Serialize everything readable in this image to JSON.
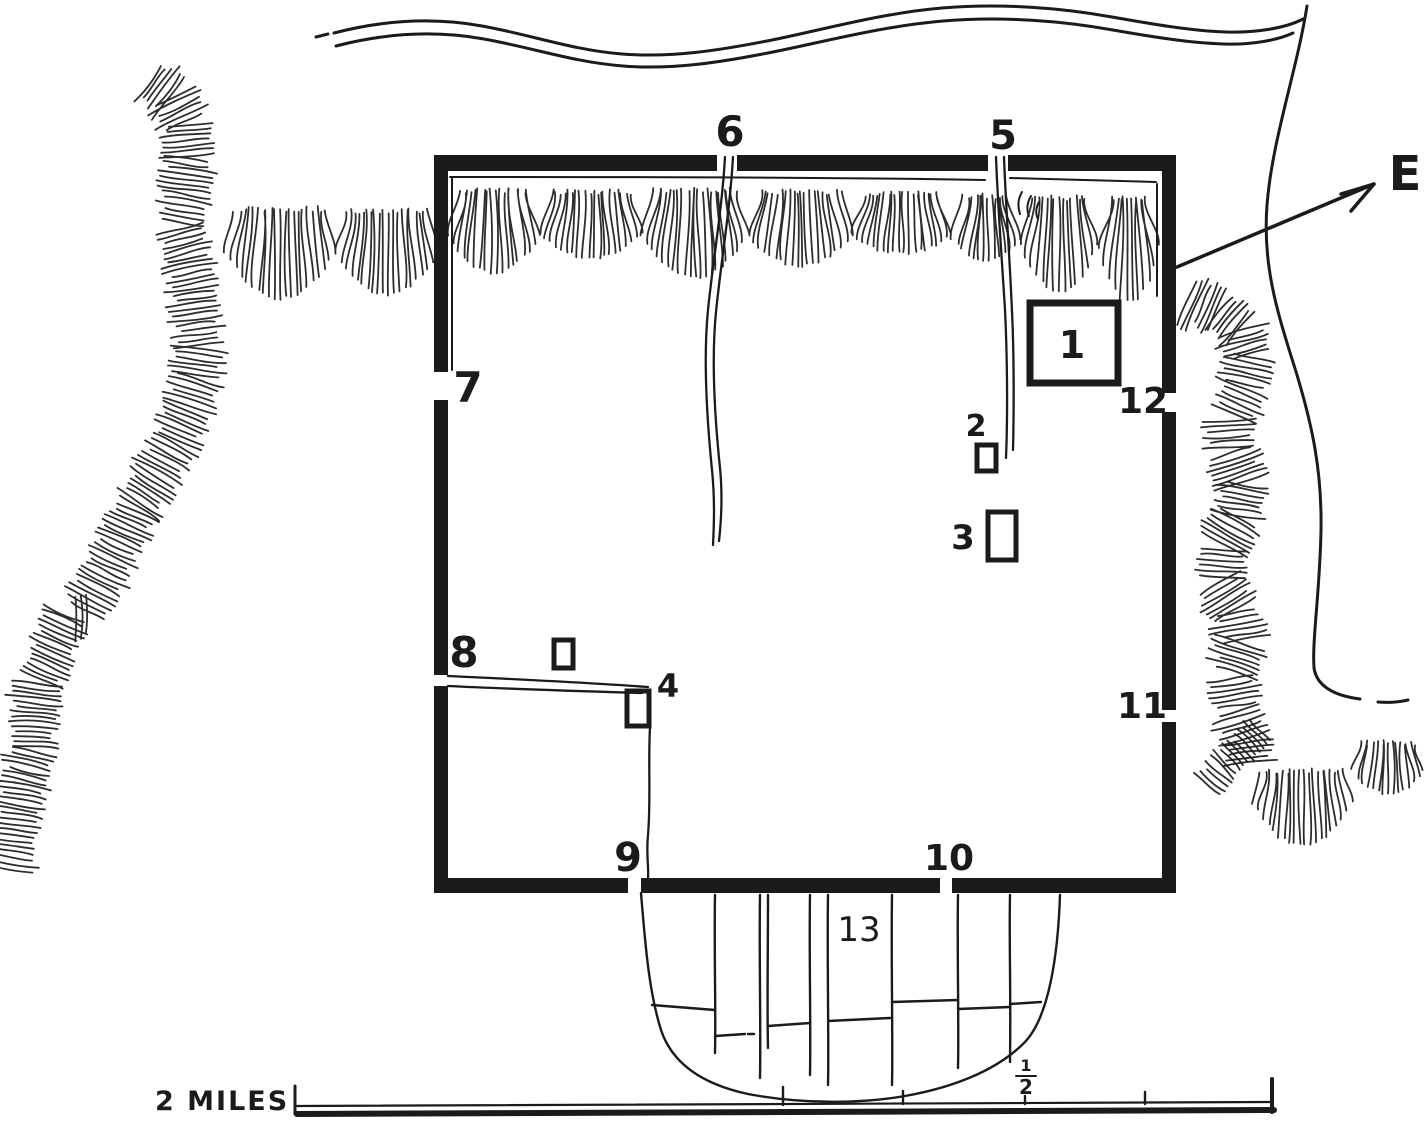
{
  "palette": {
    "ink": "#1b1b1b",
    "paper": "#ffffff"
  },
  "markers": {
    "n1": "1",
    "n2": "2",
    "n3": "3",
    "n4": "4",
    "n5": "5",
    "n6": "6",
    "n7": "7",
    "n8": "8",
    "n9": "9",
    "n10": "10",
    "n11": "11",
    "n12": "12",
    "n13": "13"
  },
  "compass": {
    "east_label": "E"
  },
  "scale_bar": {
    "caption": "2 MILES",
    "fraction_numerator": "1",
    "fraction_denominator": "2"
  }
}
